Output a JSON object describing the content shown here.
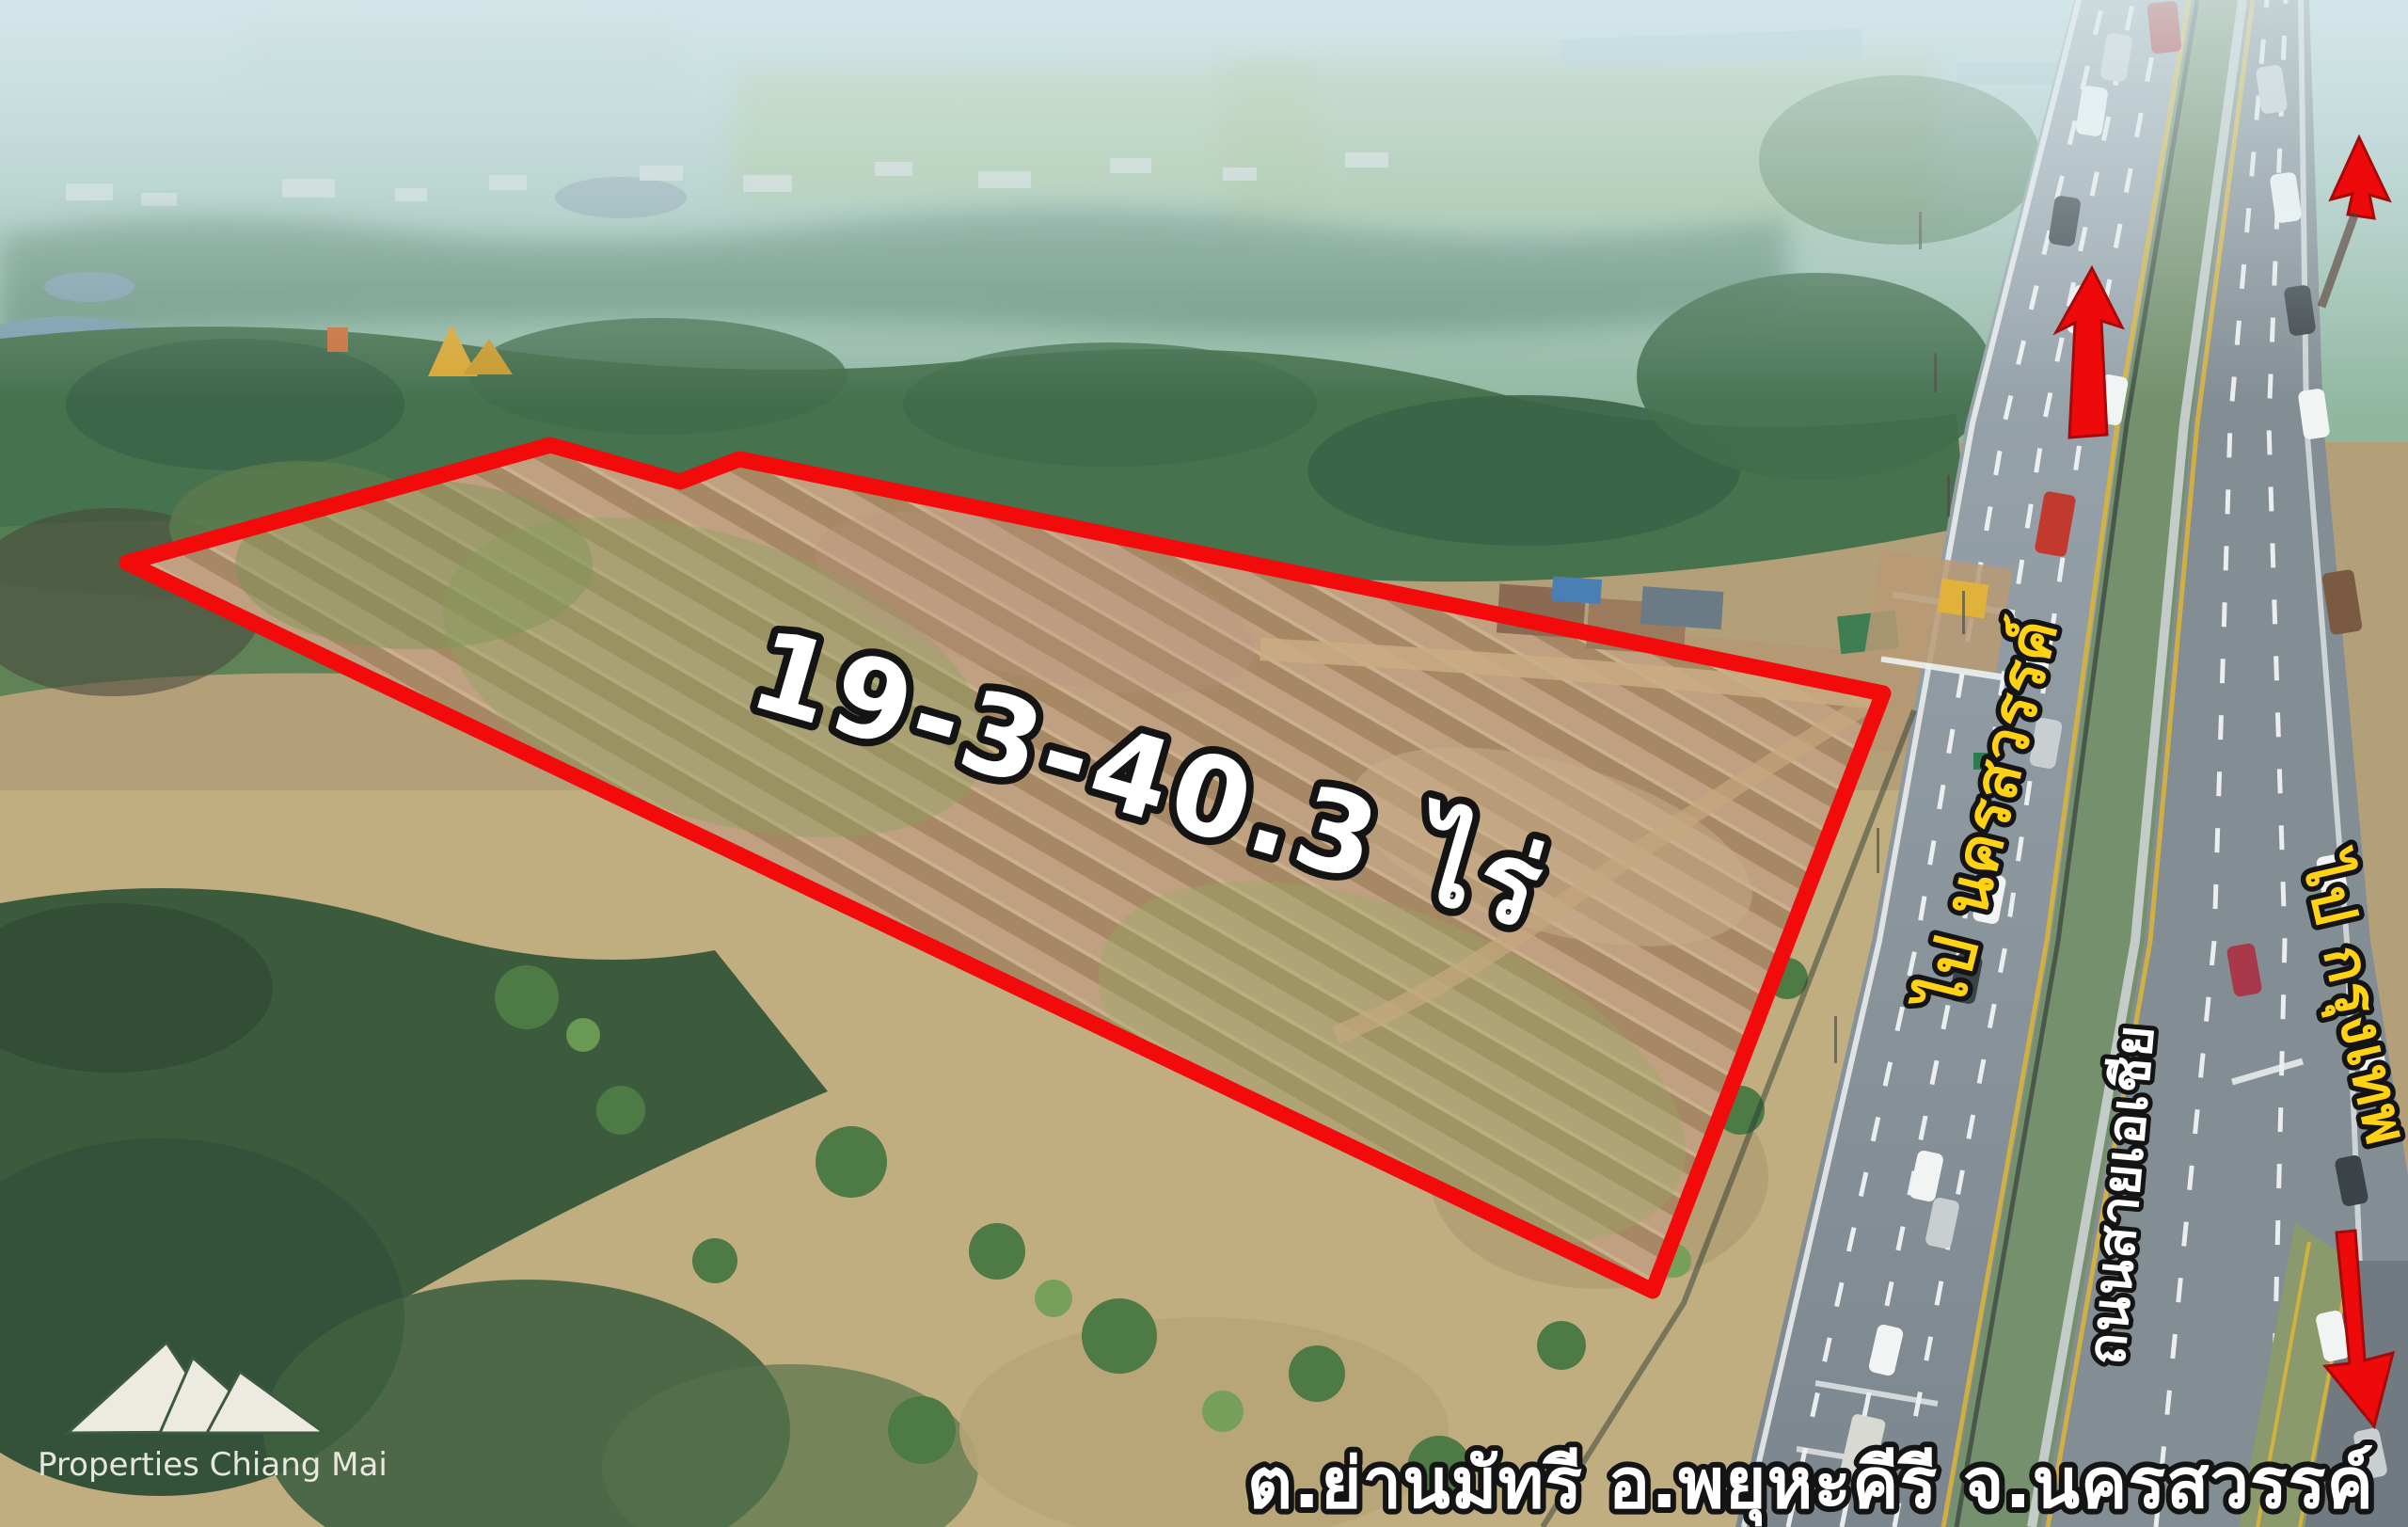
{
  "image_type": "aerial-drone-photo-land-listing",
  "annotations": {
    "area_label": "19-3-40.3 ไร่",
    "direction_north_label": "ไป นครสวรรค์",
    "road_name_label": "ถนนสายเอเชีย",
    "direction_south_label": "ไป กรุงเทพ",
    "location_label": "ต.ย่านมัทรี อ.พยุหะคีรี จ.นครสวรรค์"
  },
  "watermark": {
    "brand": "Properties Chiang Mai"
  },
  "icons": {
    "logo": "mountains-icon",
    "arrow_north": "arrow-up-icon",
    "arrow_far_north": "arrow-up-small-icon",
    "arrow_south": "arrow-down-icon"
  },
  "colors": {
    "boundary_red": "#f30a0a",
    "direction_yellow": "#ffd215",
    "label_white": "#ffffff",
    "outline_black": "#141414"
  }
}
